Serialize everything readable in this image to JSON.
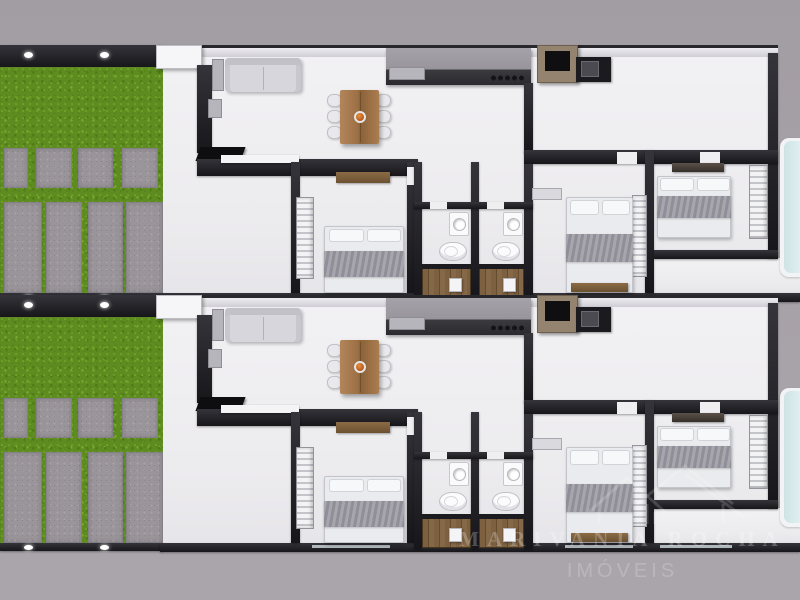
{
  "watermark": {
    "line1": "MARIVANIA ROCHA",
    "line2": "IMÓVEIS",
    "logo_icon": "house-roofs-icon",
    "text_color": "#ffffff",
    "opacity": 0.22
  },
  "palette": {
    "background_gray": "#a7a2a8",
    "floor_white": "#f0eff2",
    "wall_dark": "#1e1d21",
    "wall_light": "#e9e8ec",
    "grass_green": "#5e8c20",
    "paver_gray": "#9a959a",
    "table_wood": "#a87c4f",
    "centerpiece_orange": "#c96a1e",
    "sofa_gray": "#d7d6dc",
    "blanket_gray": "#9b9aa2",
    "wardrobe_white": "#f3f3f6",
    "shelf_brown": "#7d6142",
    "appliance_black": "#141414",
    "appliance_frame_taupe": "#93836f",
    "shower_wood": "#7d6040",
    "pool_blue": "#d7e9eb"
  },
  "scene": {
    "canvas": {
      "width": 800,
      "height": 600
    },
    "unit_size": {
      "width": 800,
      "height": 250
    },
    "units": [
      {
        "id": "unit-1",
        "top": 45
      },
      {
        "id": "unit-2",
        "top": 295
      }
    ],
    "elements": [
      {
        "n": "unit-floor",
        "c": "floor",
        "x": 160,
        "y": 0,
        "w": 618,
        "h": 250
      },
      {
        "n": "pool-deck-floor",
        "c": "floor",
        "x": 653,
        "y": 213,
        "w": 147,
        "h": 35
      },
      {
        "n": "yard-wall-top",
        "c": "wall-dark",
        "x": 0,
        "y": 0,
        "w": 163,
        "h": 22
      },
      {
        "n": "yard-light",
        "c": "light-dot",
        "x": 24,
        "y": 7,
        "w": 9,
        "h": 6
      },
      {
        "n": "yard-light",
        "c": "light-dot",
        "x": 100,
        "y": 7,
        "w": 9,
        "h": 6
      },
      {
        "n": "grass-lawn",
        "c": "grass",
        "x": 0,
        "y": 22,
        "w": 163,
        "h": 226
      },
      {
        "n": "paver-square",
        "c": "paver",
        "x": 4,
        "y": 103,
        "w": 24,
        "h": 40
      },
      {
        "n": "paver-square",
        "c": "paver",
        "x": 36,
        "y": 103,
        "w": 36,
        "h": 40
      },
      {
        "n": "paver-square",
        "c": "paver",
        "x": 78,
        "y": 103,
        "w": 35,
        "h": 40
      },
      {
        "n": "paver-square",
        "c": "paver",
        "x": 122,
        "y": 103,
        "w": 36,
        "h": 40
      },
      {
        "n": "paver-strip",
        "c": "paver",
        "x": 4,
        "y": 157,
        "w": 38,
        "h": 91
      },
      {
        "n": "paver-strip",
        "c": "paver",
        "x": 46,
        "y": 157,
        "w": 36,
        "h": 91
      },
      {
        "n": "paver-strip",
        "c": "paver",
        "x": 88,
        "y": 157,
        "w": 35,
        "h": 91
      },
      {
        "n": "paver-strip",
        "c": "paver",
        "x": 126,
        "y": 157,
        "w": 37,
        "h": 91
      },
      {
        "n": "yard-wall-bottom",
        "c": "wall-dark",
        "x": 0,
        "y": 248,
        "w": 163,
        "h": 8
      },
      {
        "n": "yard-light",
        "c": "light-dot",
        "x": 24,
        "y": 250,
        "w": 9,
        "h": 5
      },
      {
        "n": "yard-light",
        "c": "light-dot",
        "x": 100,
        "y": 250,
        "w": 9,
        "h": 5
      },
      {
        "n": "front-wall",
        "c": "wall-top",
        "x": 160,
        "y": 0,
        "w": 618,
        "h": 12
      },
      {
        "n": "entry-pillar",
        "c": "pillar",
        "x": 156,
        "y": 0,
        "w": 46,
        "h": 24
      },
      {
        "n": "right-wall",
        "c": "wall-dark",
        "x": 768,
        "y": 8,
        "w": 10,
        "h": 205
      },
      {
        "n": "back-wall",
        "c": "wall-dark",
        "x": 160,
        "y": 248,
        "w": 640,
        "h": 9
      },
      {
        "n": "window-strip",
        "c": "window-strip",
        "x": 312,
        "y": 250,
        "w": 78,
        "h": 3
      },
      {
        "n": "window-strip",
        "c": "window-strip",
        "x": 565,
        "y": 250,
        "w": 68,
        "h": 3
      },
      {
        "n": "window-strip",
        "c": "window-strip",
        "x": 660,
        "y": 250,
        "w": 72,
        "h": 3
      },
      {
        "n": "tall-cabinet",
        "c": "wall-dark",
        "x": 197,
        "y": 20,
        "w": 15,
        "h": 88
      },
      {
        "n": "cabinet-cap",
        "c": "gray-box",
        "x": 208,
        "y": 54,
        "w": 14,
        "h": 19
      },
      {
        "n": "tv-panel",
        "c": "tv",
        "x": 198,
        "y": 102,
        "w": 45,
        "h": 14
      },
      {
        "n": "living-wall",
        "c": "wall-dark",
        "x": 197,
        "y": 114,
        "w": 221,
        "h": 17
      },
      {
        "n": "tv-bench",
        "c": "white-shelf",
        "x": 221,
        "y": 110,
        "w": 78,
        "h": 8
      },
      {
        "n": "sofa-side-table",
        "c": "gray-box",
        "x": 212,
        "y": 14,
        "w": 12,
        "h": 32
      },
      {
        "n": "sofa",
        "c": "sofa",
        "x": 225,
        "y": 13,
        "w": 76,
        "h": 34
      },
      {
        "n": "dining-chair",
        "c": "chair",
        "x": 327,
        "y": 49,
        "w": 15,
        "h": 13
      },
      {
        "n": "dining-chair",
        "c": "chair",
        "x": 327,
        "y": 65,
        "w": 15,
        "h": 13
      },
      {
        "n": "dining-chair",
        "c": "chair",
        "x": 327,
        "y": 81,
        "w": 15,
        "h": 13
      },
      {
        "n": "dining-chair",
        "c": "chair",
        "x": 376,
        "y": 49,
        "w": 15,
        "h": 13
      },
      {
        "n": "dining-chair",
        "c": "chair",
        "x": 376,
        "y": 65,
        "w": 15,
        "h": 13
      },
      {
        "n": "dining-chair",
        "c": "chair",
        "x": 376,
        "y": 81,
        "w": 15,
        "h": 13
      },
      {
        "n": "dining-table",
        "c": "table-wood",
        "x": 340,
        "y": 45,
        "w": 39,
        "h": 54
      },
      {
        "n": "table-centerpiece",
        "c": "centerpiece",
        "x": 354,
        "y": 66,
        "w": 12,
        "h": 12
      },
      {
        "n": "kitchen-counter",
        "c": "counter",
        "x": 386,
        "y": 3,
        "w": 145,
        "h": 37
      },
      {
        "n": "counter-appliance",
        "c": "gray-box",
        "x": 389,
        "y": 22,
        "w": 36,
        "h": 13
      },
      {
        "n": "stove-knobs",
        "c": "knobs",
        "x": 490,
        "y": 28,
        "w": 34,
        "h": 10
      },
      {
        "n": "oven-microwave",
        "c": "micro",
        "x": 537,
        "y": 0,
        "w": 41,
        "h": 38
      },
      {
        "n": "kitchen-sink-unit",
        "c": "black-box",
        "x": 576,
        "y": 12,
        "w": 35,
        "h": 25
      },
      {
        "n": "sink-basin",
        "c": "sink-basin",
        "x": 581,
        "y": 16,
        "w": 18,
        "h": 16
      },
      {
        "n": "hall-wall",
        "c": "wall-dark",
        "x": 524,
        "y": 38,
        "w": 9,
        "h": 70
      },
      {
        "n": "bedrooms-front-wall",
        "c": "wall-dark",
        "x": 524,
        "y": 105,
        "w": 254,
        "h": 14
      },
      {
        "n": "door-gap",
        "c": "floor-gap",
        "x": 617,
        "y": 107,
        "w": 20,
        "h": 12
      },
      {
        "n": "door-gap",
        "c": "floor-gap",
        "x": 700,
        "y": 107,
        "w": 20,
        "h": 12
      },
      {
        "n": "bedroom1-left-wall",
        "c": "wall-dark",
        "x": 291,
        "y": 117,
        "w": 9,
        "h": 131
      },
      {
        "n": "bedroom1-right-wall",
        "c": "wall-dark",
        "x": 407,
        "y": 117,
        "w": 9,
        "h": 131
      },
      {
        "n": "door-gap",
        "c": "floor-gap",
        "x": 407,
        "y": 122,
        "w": 9,
        "h": 18
      },
      {
        "n": "bedroom1-shelf",
        "c": "shelf-brown",
        "x": 336,
        "y": 127,
        "w": 54,
        "h": 11
      },
      {
        "n": "bedroom1-wardrobe",
        "c": "louver",
        "x": 296,
        "y": 152,
        "w": 18,
        "h": 82
      },
      {
        "n": "bed-base",
        "c": "bed-base",
        "x": 324,
        "y": 181,
        "w": 80,
        "h": 67
      },
      {
        "n": "bed-pillow",
        "c": "pillow",
        "x": 329,
        "y": 184,
        "w": 35,
        "h": 13
      },
      {
        "n": "bed-pillow",
        "c": "pillow",
        "x": 367,
        "y": 184,
        "w": 34,
        "h": 13
      },
      {
        "n": "bed-blanket",
        "c": "blanket",
        "x": 324,
        "y": 206,
        "w": 80,
        "h": 26
      },
      {
        "n": "bath-wall-left",
        "c": "wall-dark",
        "x": 414,
        "y": 117,
        "w": 8,
        "h": 137
      },
      {
        "n": "bath-wall-mid",
        "c": "wall-dark",
        "x": 471,
        "y": 117,
        "w": 8,
        "h": 137
      },
      {
        "n": "bath-wall-right",
        "c": "wall-dark",
        "x": 524,
        "y": 119,
        "w": 9,
        "h": 135
      },
      {
        "n": "bath-front-wall",
        "c": "wall-dark",
        "x": 414,
        "y": 157,
        "w": 119,
        "h": 7
      },
      {
        "n": "door-gap",
        "c": "floor-gap",
        "x": 430,
        "y": 157,
        "w": 17,
        "h": 7
      },
      {
        "n": "door-gap",
        "c": "floor-gap",
        "x": 487,
        "y": 157,
        "w": 17,
        "h": 7
      },
      {
        "n": "bathroom-sink",
        "c": "sink-counter",
        "x": 449,
        "y": 167,
        "w": 20,
        "h": 24
      },
      {
        "n": "toilet",
        "c": "toilet",
        "x": 439,
        "y": 197,
        "w": 28,
        "h": 19
      },
      {
        "n": "shower-floor",
        "c": "shower-wood",
        "x": 422,
        "y": 220,
        "w": 49,
        "h": 33
      },
      {
        "n": "shower-glass",
        "c": "glass-strip",
        "x": 422,
        "y": 219,
        "w": 49,
        "h": 5
      },
      {
        "n": "shower-valve",
        "c": "white-chip",
        "x": 449,
        "y": 233,
        "w": 13,
        "h": 14
      },
      {
        "n": "bathroom-sink",
        "c": "sink-counter",
        "x": 503,
        "y": 167,
        "w": 20,
        "h": 24
      },
      {
        "n": "toilet",
        "c": "toilet",
        "x": 492,
        "y": 197,
        "w": 28,
        "h": 19
      },
      {
        "n": "shower-floor",
        "c": "shower-wood",
        "x": 479,
        "y": 220,
        "w": 45,
        "h": 33
      },
      {
        "n": "shower-glass",
        "c": "glass-strip",
        "x": 479,
        "y": 219,
        "w": 45,
        "h": 5
      },
      {
        "n": "shower-valve",
        "c": "white-chip",
        "x": 503,
        "y": 233,
        "w": 13,
        "h": 14
      },
      {
        "n": "bedroom2-right-wall",
        "c": "wall-dark",
        "x": 645,
        "y": 105,
        "w": 9,
        "h": 143
      },
      {
        "n": "bedroom2-dresser",
        "c": "gray-shelf",
        "x": 532,
        "y": 143,
        "w": 30,
        "h": 12
      },
      {
        "n": "bedroom2-wardrobe",
        "c": "louver",
        "x": 632,
        "y": 150,
        "w": 15,
        "h": 82
      },
      {
        "n": "bed-base",
        "c": "bed-base",
        "x": 566,
        "y": 152,
        "w": 67,
        "h": 96
      },
      {
        "n": "bed-pillow",
        "c": "pillow",
        "x": 570,
        "y": 155,
        "w": 29,
        "h": 15
      },
      {
        "n": "bed-pillow",
        "c": "pillow",
        "x": 602,
        "y": 155,
        "w": 28,
        "h": 15
      },
      {
        "n": "bed-blanket",
        "c": "blanket",
        "x": 566,
        "y": 189,
        "w": 67,
        "h": 28
      },
      {
        "n": "bed-foot-bench",
        "c": "shelf-brown",
        "x": 571,
        "y": 238,
        "w": 57,
        "h": 9
      },
      {
        "n": "bedroom3-bottom-wall",
        "c": "wall-dark",
        "x": 654,
        "y": 205,
        "w": 124,
        "h": 9
      },
      {
        "n": "bedroom3-shelf",
        "c": "shelf-dark",
        "x": 672,
        "y": 118,
        "w": 52,
        "h": 9
      },
      {
        "n": "bed-base",
        "c": "bed-base",
        "x": 657,
        "y": 131,
        "w": 74,
        "h": 62
      },
      {
        "n": "bed-pillow",
        "c": "pillow",
        "x": 660,
        "y": 133,
        "w": 34,
        "h": 13
      },
      {
        "n": "bed-pillow",
        "c": "pillow",
        "x": 697,
        "y": 133,
        "w": 33,
        "h": 13
      },
      {
        "n": "bed-blanket",
        "c": "blanket",
        "x": 657,
        "y": 151,
        "w": 74,
        "h": 22
      },
      {
        "n": "bedroom3-wardrobe",
        "c": "louver",
        "x": 749,
        "y": 120,
        "w": 19,
        "h": 74
      },
      {
        "n": "pool-edge",
        "c": "pool-edge",
        "x": 780,
        "y": 93,
        "w": 20,
        "h": 139
      },
      {
        "n": "pool",
        "c": "pool",
        "x": 784,
        "y": 96,
        "w": 16,
        "h": 132
      }
    ]
  }
}
